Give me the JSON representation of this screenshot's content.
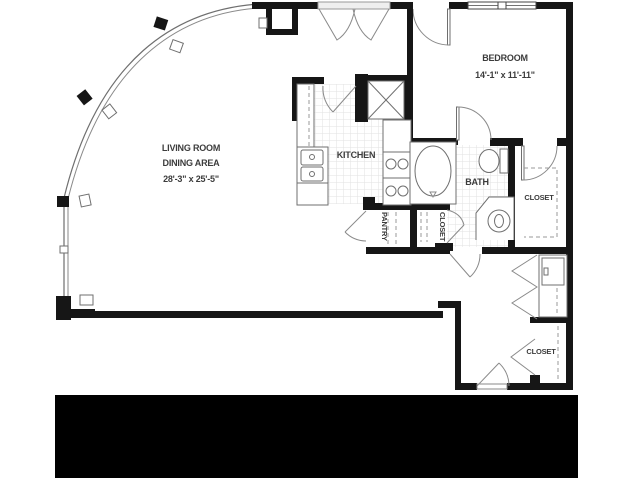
{
  "plan": {
    "type": "apartment-floor-plan",
    "rooms": {
      "living": {
        "label1": "LIVING ROOM",
        "label2": "DINING AREA",
        "dims": "28'-3\" x 25'-5\""
      },
      "bedroom": {
        "label": "BEDROOM",
        "dims": "14'-1\" x 11'-11\""
      },
      "kitchen": {
        "label": "KITCHEN"
      },
      "bath": {
        "label": "BATH"
      },
      "pantry": {
        "label": "PANTRY"
      },
      "linen_closet": {
        "label": "CLOSET"
      },
      "bedroom_closet": {
        "label": "CLOSET"
      },
      "entry_closet": {
        "label": "CLOSET"
      }
    },
    "colors": {
      "wall": "#161616",
      "fixture_line": "#6f6f6f",
      "tile_grid": "#e2e2e2",
      "text": "#3c3c3c",
      "footer_bar": "#000000"
    }
  }
}
